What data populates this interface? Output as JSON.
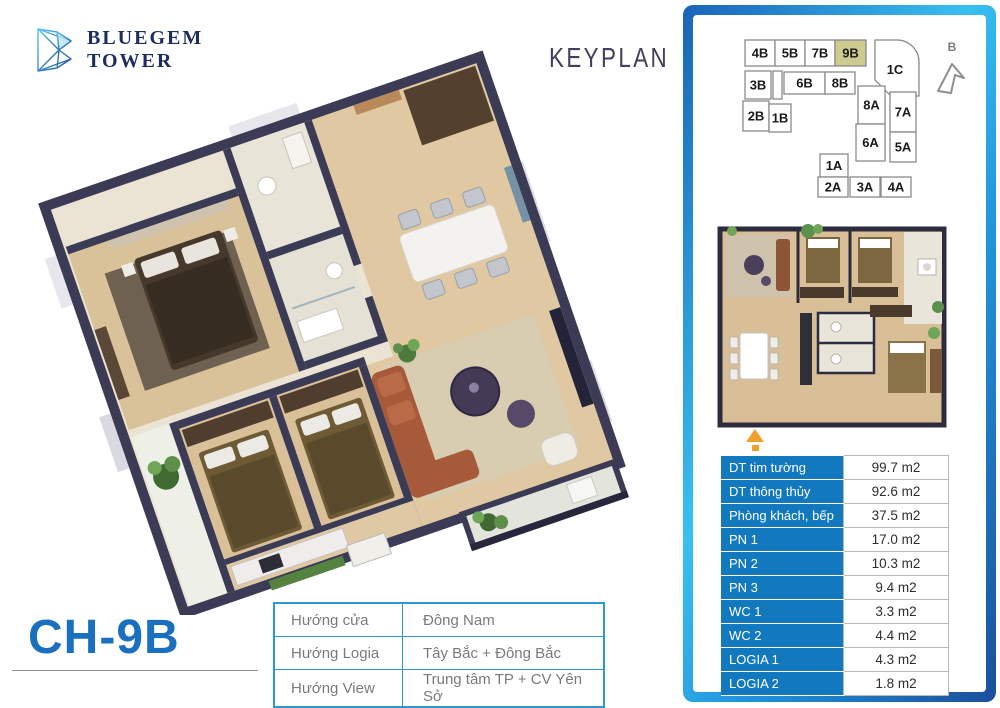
{
  "brand": {
    "line1": "BLUEGEM",
    "line2": "TOWER"
  },
  "keyplan_title": "KEYPLAN",
  "unit_code": "CH-9B",
  "compass": {
    "label": "B"
  },
  "keyplan": {
    "highlighted": "9B",
    "units": [
      {
        "label": "4B"
      },
      {
        "label": "5B"
      },
      {
        "label": "7B"
      },
      {
        "label": "9B"
      },
      {
        "label": "1C"
      },
      {
        "label": "3B"
      },
      {
        "label": "6B"
      },
      {
        "label": "8B"
      },
      {
        "label": "2B"
      },
      {
        "label": "1B"
      },
      {
        "label": "8A"
      },
      {
        "label": "7A"
      },
      {
        "label": "6A"
      },
      {
        "label": "5A"
      },
      {
        "label": "1A"
      },
      {
        "label": "2A"
      },
      {
        "label": "3A"
      },
      {
        "label": "4A"
      }
    ]
  },
  "area_table": {
    "rows": [
      {
        "label": "DT tim tường",
        "value": "99.7 m2"
      },
      {
        "label": "DT thông thủy",
        "value": "92.6 m2"
      },
      {
        "label": "Phòng khách, bếp",
        "value": "37.5 m2"
      },
      {
        "label": "PN 1",
        "value": "17.0 m2"
      },
      {
        "label": "PN 2",
        "value": "10.3 m2"
      },
      {
        "label": "PN 3",
        "value": "9.4 m2"
      },
      {
        "label": "WC 1",
        "value": "3.3 m2"
      },
      {
        "label": "WC 2",
        "value": "4.4 m2"
      },
      {
        "label": "LOGIA 1",
        "value": "4.3 m2"
      },
      {
        "label": "LOGIA 2",
        "value": "1.8 m2"
      }
    ]
  },
  "orientation_table": {
    "rows": [
      {
        "label": "Hướng cửa",
        "value": "Đông Nam"
      },
      {
        "label": "Hướng Logia",
        "value": "Tây Bắc + Đông Bắc"
      },
      {
        "label": "Hướng View",
        "value": "Trung tâm TP + CV Yên Sở"
      }
    ]
  },
  "colors": {
    "accent_blue": "#1379bf",
    "title_blue": "#1a6fbf",
    "frame_gradient": [
      "#1a63b8",
      "#38c0f0",
      "#1b4f9c"
    ],
    "highlight_unit": "#ceca90",
    "wall_navy": "#3b3b56",
    "entrance_arrow_orange": "#f0a12c"
  }
}
